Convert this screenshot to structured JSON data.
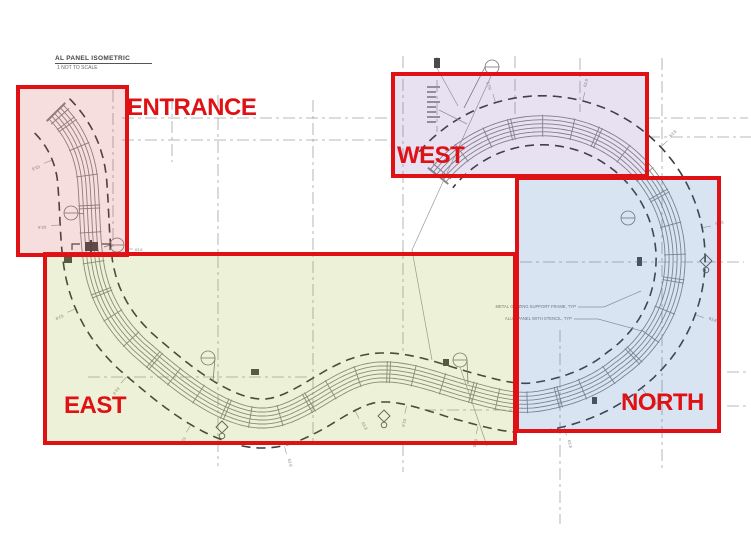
{
  "title_block": {
    "title": "AL PANEL ISOMETRIC",
    "scale_note": "1   NOT TO SCALE"
  },
  "regions": {
    "entrance": {
      "label": "ENTRANCE"
    },
    "west": {
      "label": "WEST"
    },
    "east": {
      "label": "EAST"
    },
    "north": {
      "label": "NORTH"
    }
  },
  "colors": {
    "highlight_red": "#e01114",
    "entrance_fill": "rgba(205,70,70,0.18)",
    "west_fill": "rgba(110,80,180,0.17)",
    "east_fill": "rgba(150,170,20,0.17)",
    "north_fill": "rgba(60,120,190,0.20)",
    "line": "#878787",
    "dash": "#3c3c3c",
    "centerline": "#a2a2a2",
    "flag": "#4a4a4a",
    "annotation": "#777777"
  },
  "drawing": {
    "dim_label": "63.8",
    "notes": [
      "METAL GLAZING SUPPORT FRAME, TYP",
      "ALUM PANEL WITH STENCIL, TYP"
    ]
  }
}
